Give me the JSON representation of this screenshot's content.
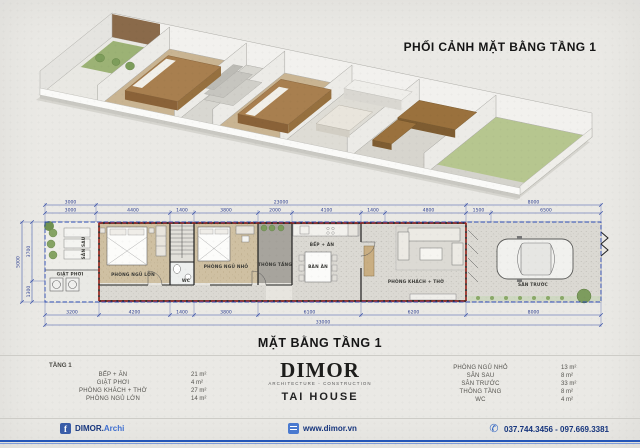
{
  "titles": {
    "perspective": "PHỐI CẢNH MẶT BẰNG TẦNG 1",
    "plan": "MẶT BẰNG TẦNG 1"
  },
  "plan": {
    "rooms": {
      "san_sau": "SÂN SAU",
      "giat_phoi": "GIẶT PHƠI",
      "ngu_lon": "PHÒNG NGỦ LỚN",
      "wc": "WC",
      "ngu_nho": "PHÒNG NGỦ NHỎ",
      "thong_tang": "THÔNG TẦNG",
      "bep_an": "BẾP + ĂN",
      "ban_an": "BÀN ĂN",
      "khach_tho": "PHÒNG KHÁCH + THỜ",
      "san_truoc": "SÂN TRƯỚC"
    },
    "dims_top_row1": [
      "3000",
      "23000",
      "8000"
    ],
    "dims_top_row2": [
      "3000",
      "4400",
      "1400",
      "3800",
      "2000",
      "4100",
      "1400",
      "4800",
      "1500",
      "6500"
    ],
    "dims_bottom_row1": [
      "3200",
      "4200",
      "1400",
      "3800",
      "6100",
      "6200",
      "8000"
    ],
    "dims_bottom_total": "33000",
    "dims_left": {
      "total": "5000",
      "upper": "3700",
      "lower": "1300"
    }
  },
  "legend": {
    "floor_label": "TẦNG 1",
    "left_rows": [
      {
        "label": "BẾP + ĂN",
        "value": "21 m²"
      },
      {
        "label": "GIẶT PHƠI",
        "value": "4 m²"
      },
      {
        "label": "PHÒNG KHÁCH + THỜ",
        "value": "27 m²"
      },
      {
        "label": "PHÒNG NGỦ LỚN",
        "value": "14 m²"
      }
    ],
    "right_rows": [
      {
        "label": "PHÒNG NGỦ NHỎ",
        "value": "13 m²"
      },
      {
        "label": "SÂN SAU",
        "value": "8 m²"
      },
      {
        "label": "SÂN TRƯỚC",
        "value": "33 m²"
      },
      {
        "label": "THÔNG TẦNG",
        "value": "8 m²"
      },
      {
        "label": "WC",
        "value": "4 m²"
      }
    ]
  },
  "brand": {
    "name": "DIMOR",
    "tagline": "ARCHITECTURE - CONSTRUCTION",
    "project": "TAI HOUSE"
  },
  "footer": {
    "facebook_bold": "DIMOR.",
    "facebook_light": "Archi",
    "website": "www.dimor.vn",
    "phones": "037.744.3456 - 097.669.3381"
  },
  "colors": {
    "dimension_blue": "#3a52a8",
    "boundary_red": "#cf2418",
    "footer_blue": "#2456b8",
    "wood_brown": "#a87f4f",
    "lawn_green": "#b6c68f"
  }
}
